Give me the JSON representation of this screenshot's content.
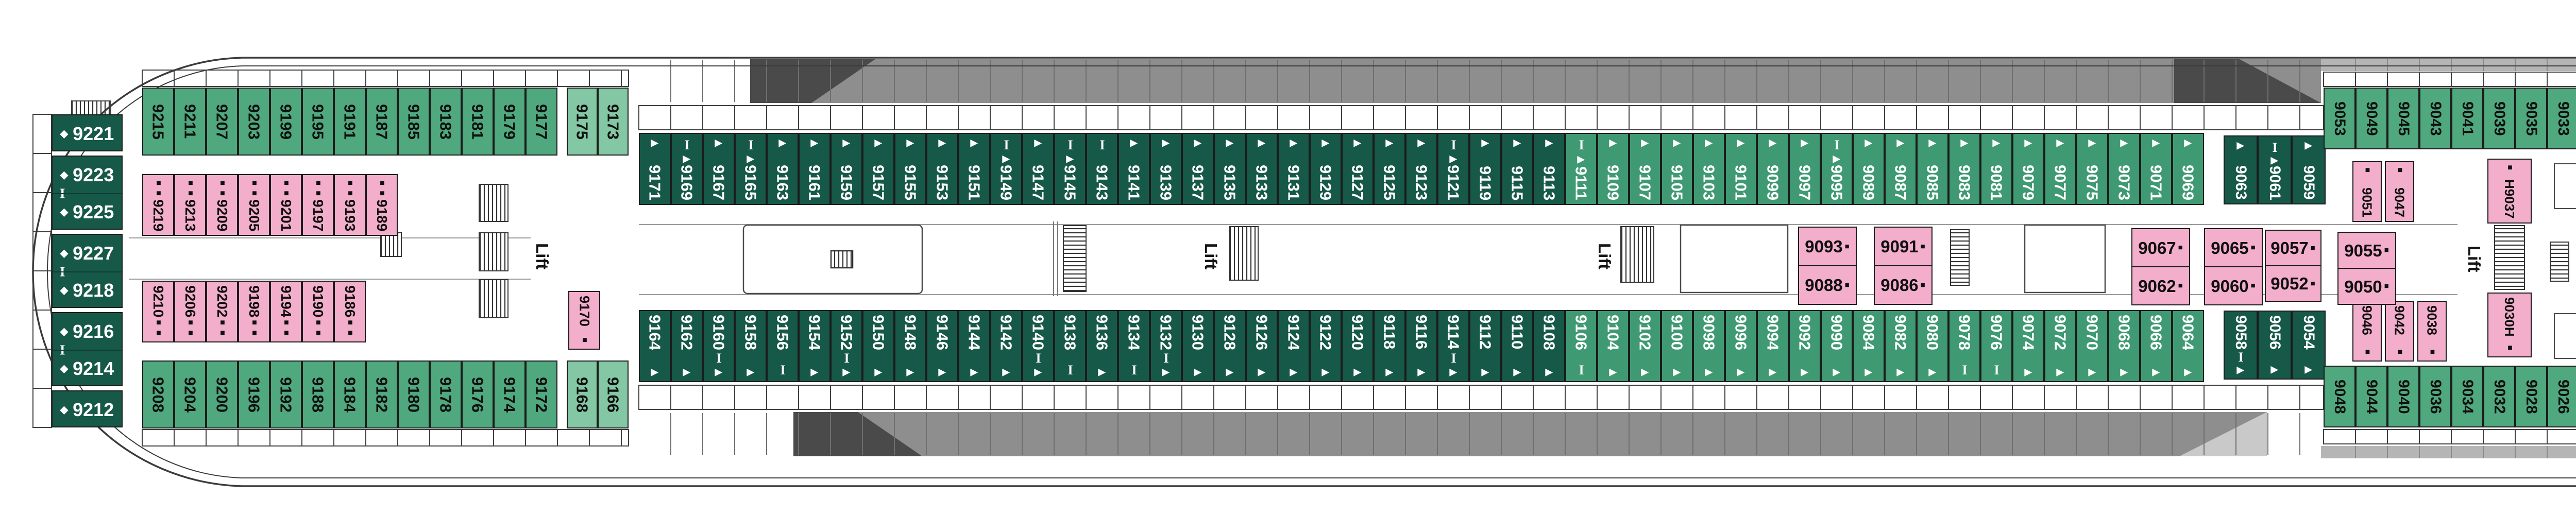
{
  "title": "deck-plan",
  "labels": {
    "lift": "Lift"
  },
  "colors": {
    "green_oceanview": "#4FA87E",
    "green_light": "#83C7A4",
    "green_balcony_dark": "#175949",
    "green_balcony_medium": "#3F9A74",
    "pink_interior": "#F3AECB",
    "deck_band_grey": "#8E8E8E",
    "deck_band_dark": "#4A4A4A",
    "deck_band_light": "#C9C9C9",
    "bow_strip_grey": "#B5B5B5",
    "hull_line": "#3B3B3B"
  },
  "icon_legend": {
    "t": "triangle-berth-icon",
    "i": "ibeam-berth-icon",
    "s": "sofabed-square-icon",
    "ss": "double-sofabed-square-icon",
    "d": "diamond-suite-icon"
  },
  "aft_suites": {
    "groups": [
      [
        {
          "n": "9221",
          "m": "d"
        }
      ],
      [
        {
          "n": "9223",
          "m": "d"
        },
        {
          "n": "9225",
          "m": "d"
        }
      ],
      [
        {
          "n": "9227",
          "m": "d"
        },
        {
          "n": "9218",
          "m": "d"
        }
      ],
      [
        {
          "n": "9216",
          "m": "d"
        },
        {
          "n": "9214",
          "m": "d"
        }
      ],
      [
        {
          "n": "9212",
          "m": "d"
        }
      ]
    ]
  },
  "rows": {
    "top_aft_green": [
      {
        "n": "9215"
      },
      {
        "n": "9211"
      },
      {
        "n": "9207"
      },
      {
        "n": "9203"
      },
      {
        "n": "9199"
      },
      {
        "n": "9195"
      },
      {
        "n": "9191"
      },
      {
        "n": "9187"
      },
      {
        "n": "9185"
      },
      {
        "n": "9183"
      },
      {
        "n": "9181"
      },
      {
        "n": "9179"
      },
      {
        "n": "9177"
      }
    ],
    "top_light": [
      {
        "n": "9175"
      },
      {
        "n": "9173"
      }
    ],
    "top_dark": [
      {
        "n": "9171",
        "m": "t"
      },
      {
        "n": "9169",
        "m": "it"
      },
      {
        "n": "9167",
        "m": "t"
      },
      {
        "n": "9165",
        "m": "it"
      },
      {
        "n": "9163",
        "m": "t"
      },
      {
        "n": "9161",
        "m": "t"
      },
      {
        "n": "9159",
        "m": "t"
      },
      {
        "n": "9157",
        "m": "t"
      },
      {
        "n": "9155",
        "m": "t"
      },
      {
        "n": "9153",
        "m": "t"
      },
      {
        "n": "9151",
        "m": "t"
      },
      {
        "n": "9149",
        "m": "it"
      },
      {
        "n": "9147",
        "m": "t"
      },
      {
        "n": "9145",
        "m": "it"
      },
      {
        "n": "9143",
        "m": "i"
      },
      {
        "n": "9141",
        "m": "t"
      },
      {
        "n": "9139",
        "m": "t"
      },
      {
        "n": "9137",
        "m": "t"
      },
      {
        "n": "9135",
        "m": "t"
      },
      {
        "n": "9133",
        "m": "t"
      },
      {
        "n": "9131",
        "m": "t"
      },
      {
        "n": "9129",
        "m": "t"
      },
      {
        "n": "9127",
        "m": "t"
      },
      {
        "n": "9125",
        "m": "t"
      },
      {
        "n": "9123",
        "m": "t"
      },
      {
        "n": "9121",
        "m": "it"
      },
      {
        "n": "9119",
        "m": "t"
      },
      {
        "n": "9115",
        "m": "t"
      },
      {
        "n": "9113",
        "m": "t"
      }
    ],
    "top_med": [
      {
        "n": "9111",
        "m": "it"
      },
      {
        "n": "9109",
        "m": "t"
      },
      {
        "n": "9107",
        "m": "t"
      },
      {
        "n": "9105",
        "m": "t"
      },
      {
        "n": "9103",
        "m": "t"
      },
      {
        "n": "9101",
        "m": "t"
      },
      {
        "n": "9099",
        "m": "t"
      },
      {
        "n": "9097",
        "m": "t"
      },
      {
        "n": "9095",
        "m": "it"
      },
      {
        "n": "9089",
        "m": "t"
      },
      {
        "n": "9087",
        "m": "t"
      },
      {
        "n": "9085",
        "m": "t"
      },
      {
        "n": "9083",
        "m": "t"
      },
      {
        "n": "9081",
        "m": "t"
      },
      {
        "n": "9079",
        "m": "t"
      },
      {
        "n": "9077",
        "m": "t"
      },
      {
        "n": "9075",
        "m": "t"
      },
      {
        "n": "9073",
        "m": "t"
      },
      {
        "n": "9071",
        "m": "t"
      },
      {
        "n": "9069",
        "m": "t"
      }
    ],
    "top_dark_trio": [
      {
        "n": "9063",
        "m": "t"
      },
      {
        "n": "9061",
        "m": "it"
      },
      {
        "n": "9059",
        "m": "t"
      }
    ],
    "top_fwd_green": [
      {
        "n": "9053"
      },
      {
        "n": "9049"
      },
      {
        "n": "9045"
      },
      {
        "n": "9043"
      },
      {
        "n": "9041"
      },
      {
        "n": "9039"
      },
      {
        "n": "9035"
      },
      {
        "n": "9033"
      },
      {
        "n": "9031"
      },
      {
        "n": "9029"
      },
      {
        "n": "9027"
      },
      {
        "n": "9025"
      },
      {
        "n": "9023"
      },
      {
        "n": "9021"
      },
      {
        "n": "9019"
      },
      {
        "n": "9015"
      },
      {
        "n": "9013"
      },
      {
        "n": "9009"
      },
      {
        "n": "9005"
      }
    ],
    "top_pink": [
      {
        "n": "9219",
        "m": "ss"
      },
      {
        "n": "9213",
        "m": "ss"
      },
      {
        "n": "9209",
        "m": "ss"
      },
      {
        "n": "9205",
        "m": "ss"
      },
      {
        "n": "9201",
        "m": "ss"
      },
      {
        "n": "9197",
        "m": "ss"
      },
      {
        "n": "9193",
        "m": "ss"
      },
      {
        "n": "9189",
        "m": "ss"
      }
    ],
    "bow_pink": [
      {
        "n": "9011",
        "m": "ss"
      },
      {
        "n": "9007",
        "m": "ss"
      },
      {
        "n": "9003",
        "m": "s"
      }
    ],
    "bot_aft_green": [
      {
        "n": "9208"
      },
      {
        "n": "9204"
      },
      {
        "n": "9200"
      },
      {
        "n": "9196"
      },
      {
        "n": "9192"
      },
      {
        "n": "9188"
      },
      {
        "n": "9184"
      },
      {
        "n": "9182"
      },
      {
        "n": "9180"
      },
      {
        "n": "9178"
      },
      {
        "n": "9176"
      },
      {
        "n": "9174"
      },
      {
        "n": "9172"
      }
    ],
    "bot_light": [
      {
        "n": "9168"
      },
      {
        "n": "9166"
      }
    ],
    "bot_dark": [
      {
        "n": "9164",
        "m": "t"
      },
      {
        "n": "9162",
        "m": "t"
      },
      {
        "n": "9160",
        "m": "it"
      },
      {
        "n": "9158",
        "m": "t"
      },
      {
        "n": "9156",
        "m": "i"
      },
      {
        "n": "9154",
        "m": "t"
      },
      {
        "n": "9152",
        "m": "it"
      },
      {
        "n": "9150",
        "m": "t"
      },
      {
        "n": "9148",
        "m": "t"
      },
      {
        "n": "9146",
        "m": "t"
      },
      {
        "n": "9144",
        "m": "t"
      },
      {
        "n": "9142",
        "m": "t"
      },
      {
        "n": "9140",
        "m": "it"
      },
      {
        "n": "9138",
        "m": "i"
      },
      {
        "n": "9136",
        "m": "t"
      },
      {
        "n": "9134",
        "m": "i"
      },
      {
        "n": "9132",
        "m": "it"
      },
      {
        "n": "9130",
        "m": "t"
      },
      {
        "n": "9128",
        "m": "t"
      },
      {
        "n": "9126",
        "m": "t"
      },
      {
        "n": "9124",
        "m": "t"
      },
      {
        "n": "9122",
        "m": "t"
      },
      {
        "n": "9120",
        "m": "t"
      },
      {
        "n": "9118",
        "m": "t"
      },
      {
        "n": "9116",
        "m": "t"
      },
      {
        "n": "9114",
        "m": "it"
      },
      {
        "n": "9112",
        "m": "t"
      },
      {
        "n": "9110",
        "m": "t"
      },
      {
        "n": "9108",
        "m": "t"
      }
    ],
    "bot_med": [
      {
        "n": "9106",
        "m": "i"
      },
      {
        "n": "9104",
        "m": "t"
      },
      {
        "n": "9102",
        "m": "t"
      },
      {
        "n": "9100",
        "m": "t"
      },
      {
        "n": "9098",
        "m": "t"
      },
      {
        "n": "9096",
        "m": "t"
      },
      {
        "n": "9094",
        "m": "t"
      },
      {
        "n": "9092",
        "m": "t"
      },
      {
        "n": "9090",
        "m": "t"
      },
      {
        "n": "9084",
        "m": "t"
      },
      {
        "n": "9082",
        "m": "t"
      },
      {
        "n": "9080",
        "m": "t"
      },
      {
        "n": "9078",
        "m": "i"
      },
      {
        "n": "9076",
        "m": "i"
      },
      {
        "n": "9074",
        "m": "t"
      },
      {
        "n": "9072",
        "m": "t"
      },
      {
        "n": "9070",
        "m": "t"
      },
      {
        "n": "9068",
        "m": "t"
      },
      {
        "n": "9066",
        "m": "t"
      },
      {
        "n": "9064",
        "m": "t"
      }
    ],
    "bot_dark_trio": [
      {
        "n": "9058",
        "m": "it"
      },
      {
        "n": "9056",
        "m": "t"
      },
      {
        "n": "9054",
        "m": "t"
      }
    ],
    "bot_fwd_green": [
      {
        "n": "9048"
      },
      {
        "n": "9044"
      },
      {
        "n": "9040"
      },
      {
        "n": "9036"
      },
      {
        "n": "9034"
      },
      {
        "n": "9032"
      },
      {
        "n": "9028"
      },
      {
        "n": "9026"
      },
      {
        "n": "9024"
      },
      {
        "n": "9022"
      },
      {
        "n": "9020"
      },
      {
        "n": "9018"
      },
      {
        "n": "9016"
      },
      {
        "n": "9014"
      },
      {
        "n": "9012"
      },
      {
        "n": "9010"
      },
      {
        "n": "9008"
      },
      {
        "n": "9006"
      },
      {
        "n": "9004"
      }
    ],
    "bot_pink": [
      {
        "n": "9210",
        "m": "ss"
      },
      {
        "n": "9206",
        "m": "ss"
      },
      {
        "n": "9202",
        "m": "ss"
      },
      {
        "n": "9198",
        "m": "ss"
      },
      {
        "n": "9194",
        "m": "ss"
      },
      {
        "n": "9190",
        "m": "ss"
      },
      {
        "n": "9186",
        "m": "ss"
      }
    ]
  },
  "singles": [
    {
      "key": "h9001",
      "n": "H9001"
    },
    {
      "key": "h9002",
      "n": "9002H"
    },
    {
      "key": "c9170",
      "n": "9170",
      "m": "s"
    },
    {
      "key": "c9051",
      "n": "9051",
      "m": "s"
    },
    {
      "key": "c9047",
      "n": "9047",
      "m": "s"
    },
    {
      "key": "c9046",
      "n": "9046",
      "m": "s"
    },
    {
      "key": "c9042",
      "n": "9042",
      "m": "s"
    },
    {
      "key": "c9038",
      "n": "9038",
      "m": "s"
    },
    {
      "key": "h9037",
      "n": "H9037",
      "m": "s"
    },
    {
      "key": "h9030",
      "n": "9030H",
      "m": "s"
    }
  ],
  "interior_pairs": [
    {
      "key": "p9093",
      "top": {
        "n": "9093",
        "m": "s"
      },
      "bottom": {
        "n": "9088",
        "m": "s"
      }
    },
    {
      "key": "p9091",
      "top": {
        "n": "9091",
        "m": "s"
      },
      "bottom": {
        "n": "9086",
        "m": "s"
      }
    },
    {
      "key": "p9067",
      "top": {
        "n": "9067",
        "m": "s"
      },
      "bottom": {
        "n": "9062",
        "m": "s"
      }
    },
    {
      "key": "p9065",
      "top": {
        "n": "9065",
        "m": "s"
      },
      "bottom": {
        "n": "9060",
        "m": "s"
      }
    },
    {
      "key": "p9057",
      "top": {
        "n": "9057",
        "m": "s"
      },
      "bottom": {
        "n": "9052",
        "m": "s"
      }
    },
    {
      "key": "p9055",
      "top": {
        "n": "9055",
        "m": "s"
      },
      "bottom": {
        "n": "9050",
        "m": "s"
      }
    }
  ],
  "lifts": [
    {
      "id": "lift-aft"
    },
    {
      "id": "lift-midship-1"
    },
    {
      "id": "lift-midship-2"
    },
    {
      "id": "lift-forward"
    }
  ]
}
